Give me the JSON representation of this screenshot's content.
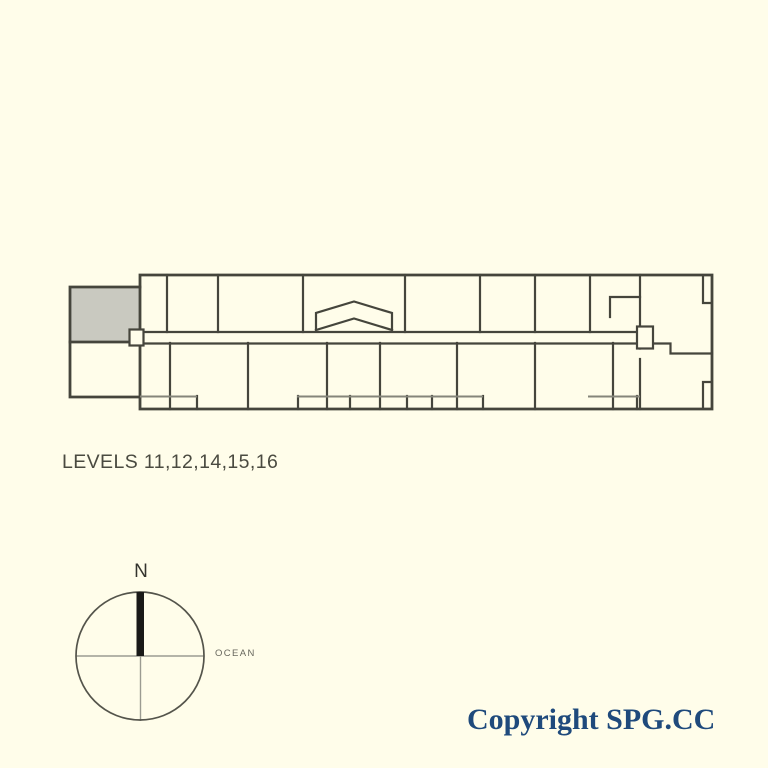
{
  "page": {
    "background_color": "#FFFDEA"
  },
  "floor_plan": {
    "levels_label": "LEVELS 11,12,14,15,16",
    "wall_color": "#45453C",
    "secondary_line_color": "#85857A",
    "gray_room_fill": "#C9C9C0",
    "interior_fill": "#FFFDEA"
  },
  "compass": {
    "north_label": "N",
    "direction_label": "OCEAN",
    "circle_color": "#54544B",
    "crosshair_color": "#9B9B91",
    "north_bar_color": "#191917"
  },
  "footer": {
    "copyright_text": "Copyright SPG.CC",
    "text_color": "#1F4A7C"
  }
}
